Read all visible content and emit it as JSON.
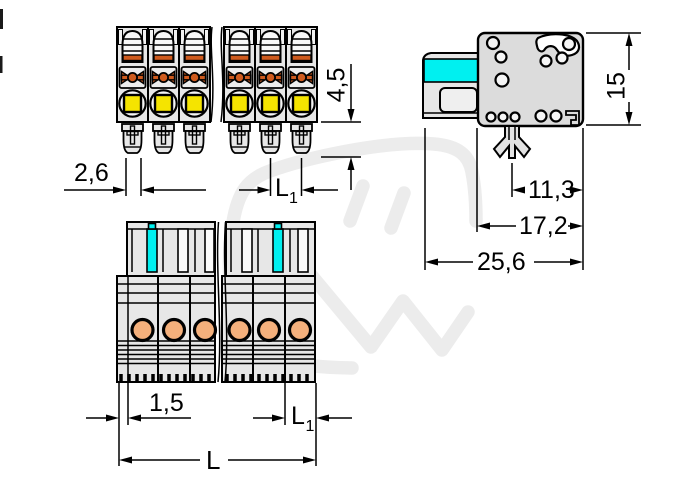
{
  "drawing": {
    "type": "connector-technical-drawing",
    "views": [
      "top-view",
      "side-view",
      "front-view"
    ],
    "dim_top": {
      "pin_width": "2,6",
      "pin_length": "4,5",
      "pitch_main": "L",
      "pitch_sub": "1"
    },
    "dim_side": {
      "height": "15",
      "foot_offset": "11,3",
      "depth": "17,2",
      "total_depth": "25,6"
    },
    "dim_front": {
      "edge_offset": "1,5",
      "pitch_main": "L",
      "pitch_sub": "1",
      "total_length": "L"
    },
    "colors": {
      "line": "#000000",
      "body_gray": "#e7e7e7",
      "side_body_gray": "#dcdcdc",
      "marking_cyan": "#00f0f0",
      "actuator_yellow": "#f5e400",
      "clamp_orange": "#cf5b1e",
      "contact_orange": "#f4b07c",
      "watermark_gray": "#ececec"
    }
  }
}
